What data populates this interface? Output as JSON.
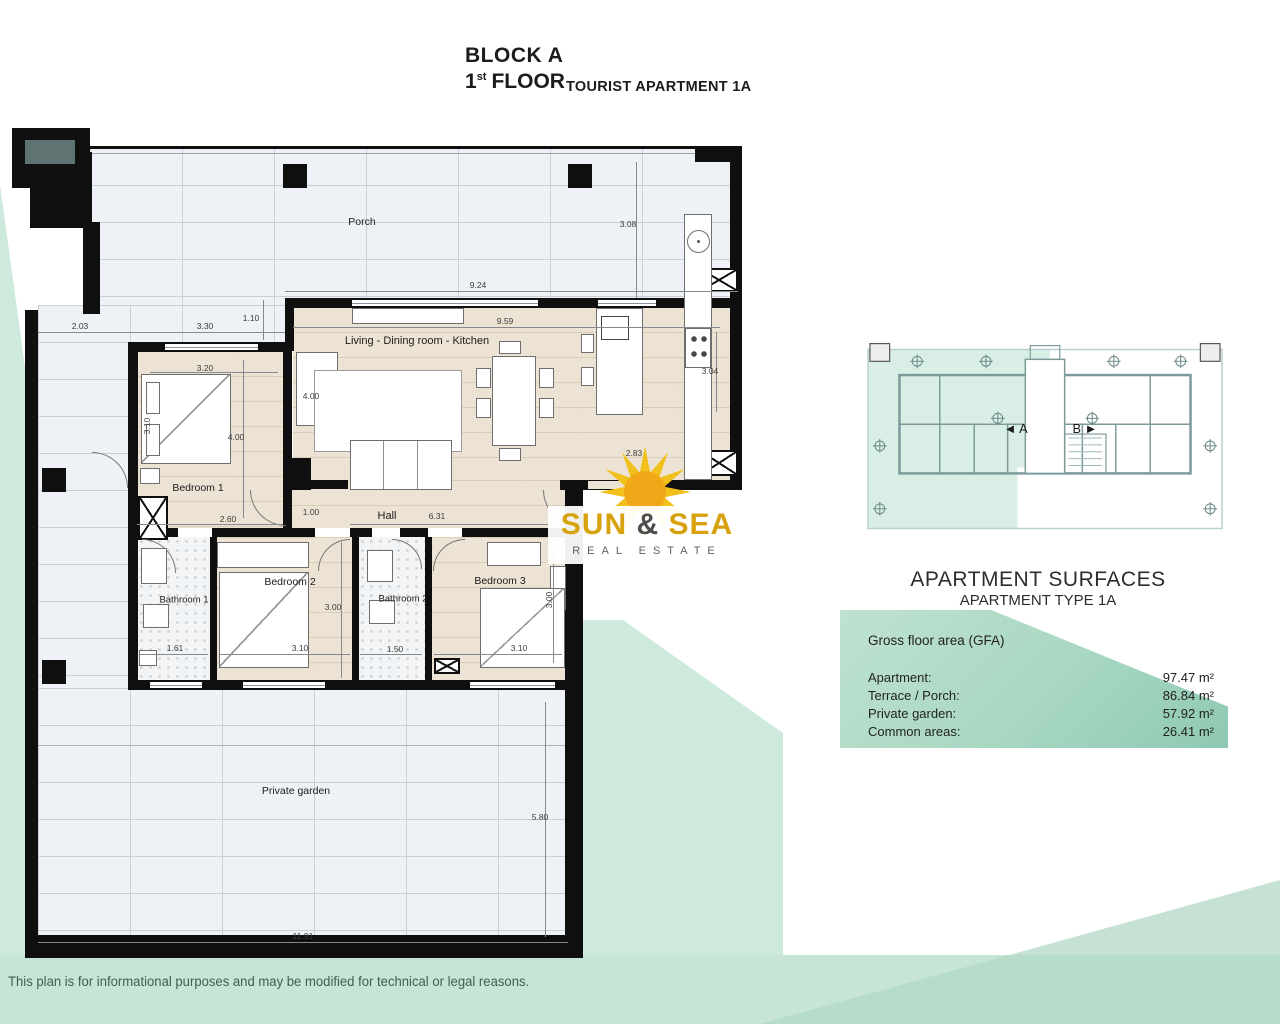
{
  "title": {
    "block": "BLOCK A",
    "floor_number": "1",
    "floor_ordinal": "st",
    "floor_word": "FLOOR",
    "apartment": "TOURIST APARTMENT 1A"
  },
  "logo": {
    "word1": "SUN",
    "ampersand": "&",
    "word2": "SEA",
    "tagline": "REAL ESTATE"
  },
  "overview": {
    "unit_a_label": "◄ A",
    "unit_b_label": "B ►"
  },
  "surfaces": {
    "title": "APARTMENT SURFACES",
    "subtitle": "APARTMENT TYPE 1A",
    "gfa_label": "Gross floor area (GFA)",
    "rows": [
      {
        "label": "Apartment:",
        "value": "97.47 m²"
      },
      {
        "label": "Terrace / Porch:",
        "value": "86.84 m²"
      },
      {
        "label": "Private garden:",
        "value": "57.92 m²"
      },
      {
        "label": "Common areas:",
        "value": "26.41 m²"
      }
    ]
  },
  "plan": {
    "room_labels": [
      {
        "label": "Porch",
        "x": 362,
        "y": 222
      },
      {
        "label": "Living - Dining room - Kitchen",
        "x": 417,
        "y": 341,
        "size": 11
      },
      {
        "label": "Bedroom 1",
        "x": 198,
        "y": 488
      },
      {
        "label": "Hall",
        "x": 387,
        "y": 516,
        "size": 11
      },
      {
        "label": "Bathroom 1",
        "x": 184,
        "y": 600,
        "size": 9.5
      },
      {
        "label": "Bedroom 2",
        "x": 290,
        "y": 582
      },
      {
        "label": "Bathroom 2",
        "x": 403,
        "y": 599,
        "size": 9.5
      },
      {
        "label": "Bedroom 3",
        "x": 500,
        "y": 581
      },
      {
        "label": "Private garden",
        "x": 296,
        "y": 791
      }
    ],
    "dimensions": [
      {
        "t": "2.03",
        "x": 80,
        "y": 326
      },
      {
        "t": "3.30",
        "x": 205,
        "y": 326
      },
      {
        "t": "1.10",
        "x": 251,
        "y": 318
      },
      {
        "t": "9.24",
        "x": 478,
        "y": 285
      },
      {
        "t": "9.59",
        "x": 505,
        "y": 321
      },
      {
        "t": "3.08",
        "x": 628,
        "y": 224
      },
      {
        "t": "3.20",
        "x": 205,
        "y": 368
      },
      {
        "t": "3.10",
        "x": 147,
        "y": 426,
        "r": -90
      },
      {
        "t": "4.00",
        "x": 236,
        "y": 437
      },
      {
        "t": "4.00",
        "x": 311,
        "y": 396
      },
      {
        "t": "3.04",
        "x": 710,
        "y": 371
      },
      {
        "t": "2.83",
        "x": 634,
        "y": 453
      },
      {
        "t": "2.60",
        "x": 228,
        "y": 519
      },
      {
        "t": "1.00",
        "x": 311,
        "y": 512
      },
      {
        "t": "6.31",
        "x": 437,
        "y": 516
      },
      {
        "t": "3.00",
        "x": 333,
        "y": 607
      },
      {
        "t": "1.61",
        "x": 175,
        "y": 648
      },
      {
        "t": "3.10",
        "x": 300,
        "y": 648
      },
      {
        "t": "1.50",
        "x": 395,
        "y": 649
      },
      {
        "t": "3.00",
        "x": 549,
        "y": 600,
        "r": -90
      },
      {
        "t": "3.10",
        "x": 519,
        "y": 648
      },
      {
        "t": "5.80",
        "x": 540,
        "y": 817
      },
      {
        "t": "11.91",
        "x": 303,
        "y": 936
      }
    ]
  },
  "disclaimer": "This plan is for informational purposes and may be modified for technical or legal reasons.",
  "colors": {
    "mint": "#cdeadd",
    "mint_dark": "#b2d8c6",
    "table_green_light": "#bfe2d0",
    "table_green_dark": "#8fc9b2",
    "sun_yellow": "#f2c01a",
    "logo_gold": "#d8a20e",
    "wall": "#0f0f0f"
  }
}
